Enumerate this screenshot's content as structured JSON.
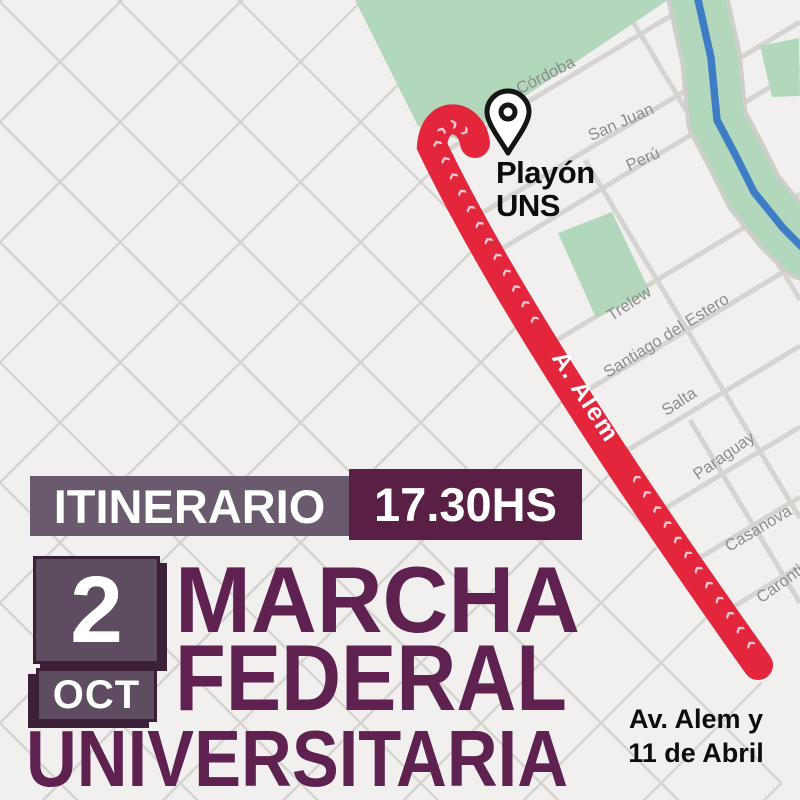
{
  "map": {
    "background_color": "#f2f0ee",
    "street_color": "#d5d4d0",
    "park_color": "#b3d7bd",
    "river_color": "#3e7dc4",
    "street_label_color": "#8d8d89",
    "streets": [
      {
        "name": "Córdoba"
      },
      {
        "name": "San Juan"
      },
      {
        "name": "Perú"
      },
      {
        "name": "Trelew"
      },
      {
        "name": "Santiago del Estero"
      },
      {
        "name": "Salta"
      },
      {
        "name": "Paraguay"
      },
      {
        "name": "Casanova"
      },
      {
        "name": "Caronti"
      }
    ],
    "route": {
      "color": "#e4263c",
      "street_label": "A. Alem",
      "chevron_char": "‹",
      "chevrons_before": 15,
      "chevrons_after": 12
    },
    "marker": {
      "label_line1": "Playón",
      "label_line2": "UNS"
    }
  },
  "overlay": {
    "itinerary_label": "ITINERARIO",
    "time": "17.30HS",
    "date_day": "2",
    "date_month": "OCT",
    "title_line1": "MARCHA",
    "title_line2": "FEDERAL",
    "title_line3": "UNIVERSITARIA",
    "meeting_point_line1": "Av. Alem y",
    "meeting_point_line2": "11 de Abril",
    "colors": {
      "itinerary_box": "#6a5a6d",
      "time_box": "#5a1f44",
      "date_box": "#5e4d61",
      "date_box_shadow": "#3b2037",
      "title_text": "#5e2150",
      "route_red": "#e4263c"
    }
  }
}
